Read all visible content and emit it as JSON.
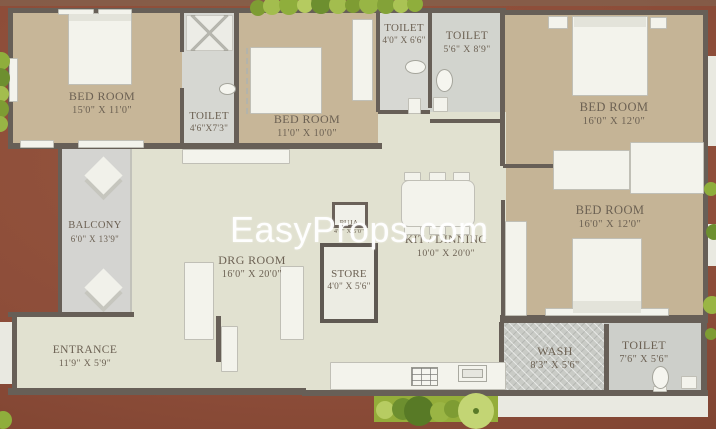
{
  "watermark": {
    "text": "EasyProps.com"
  },
  "rooms": [
    {
      "id": "bedroom-1",
      "name": "BED ROOM",
      "dims": "15'0\" X 11'0\""
    },
    {
      "id": "toilet-1",
      "name": "TOILET",
      "dims": "4'6\"X7'3\""
    },
    {
      "id": "bedroom-2",
      "name": "BED ROOM",
      "dims": "11'0\" X 10'0\""
    },
    {
      "id": "toilet-2",
      "name": "TOILET",
      "dims": "4'0\" X 6'6\""
    },
    {
      "id": "toilet-3",
      "name": "TOILET",
      "dims": "5'6\" X 8'9\""
    },
    {
      "id": "bedroom-3",
      "name": "BED ROOM",
      "dims": "16'0\" X 12'0\""
    },
    {
      "id": "bedroom-4",
      "name": "BED ROOM",
      "dims": "16'0\" X 12'0\""
    },
    {
      "id": "balcony",
      "name": "BALCONY",
      "dims": "6'0\" X 13'9\""
    },
    {
      "id": "drg-room",
      "name": "DRG ROOM",
      "dims": "16'0\" X 20'0\""
    },
    {
      "id": "puja",
      "name": "PUJA",
      "dims": "4'0\" X 5'0\""
    },
    {
      "id": "store",
      "name": "STORE",
      "dims": "4'0\" X 5'6\""
    },
    {
      "id": "kit-dinning",
      "name": "KIT / DINNING",
      "dims": "10'0\" X 20'0\""
    },
    {
      "id": "entrance",
      "name": "ENTRANCE",
      "dims": "11'9\" X 5'9\""
    },
    {
      "id": "wash",
      "name": "WASH",
      "dims": "8'3\" X 5'6\""
    },
    {
      "id": "toilet-4",
      "name": "TOILET",
      "dims": "7'6\" X 5'6\""
    }
  ],
  "colors": {
    "background_brick": "#8d4d39",
    "walls": "#675f57",
    "bedroom_floor": "#c7b698",
    "living_floor": "#e1e1d0",
    "toilet_floor": "#d6d7d2",
    "balcony_floor": "#d4d4d1",
    "furniture": "#f3f3ec",
    "plants_green": "#8fae3c",
    "label_text": "#6c6153",
    "watermark_text": "#ffffff"
  }
}
